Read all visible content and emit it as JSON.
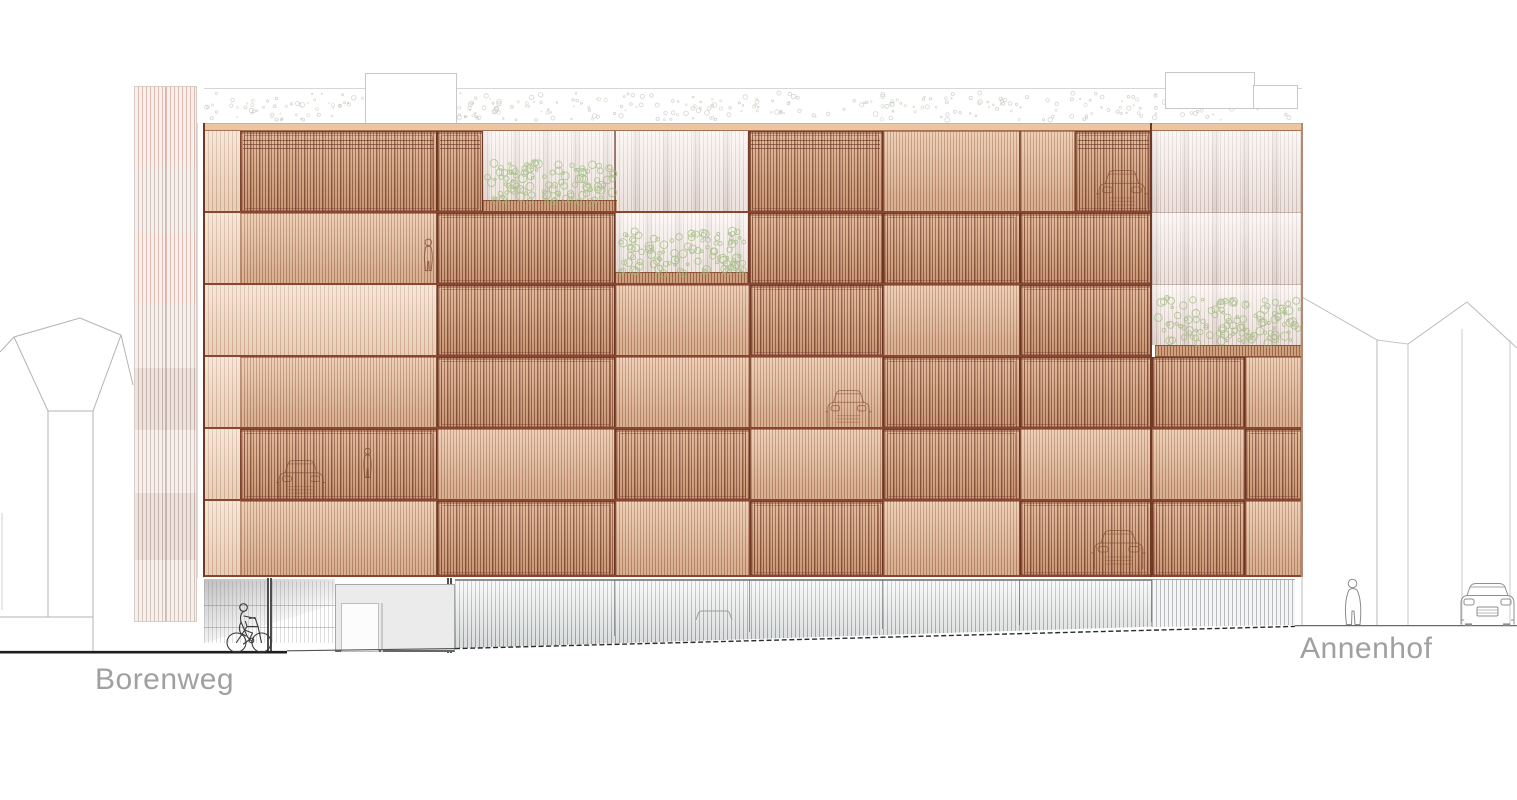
{
  "labels": {
    "street_left": "Borenweg",
    "street_right": "Annenhof"
  },
  "colors": {
    "terracotta_base": "#e8c4a5",
    "terracotta_frame": "#8a4430",
    "terracotta_dark": "#6e3a26",
    "ghost_recess": "#f8f0ec",
    "planter_wood": "#cfa07e",
    "gray_screen": "#8f8f8f",
    "vegetation_green": "#9ab877",
    "roof_planting_gray": "#aeb6a8",
    "outline_gray": "#b3b3b3",
    "figure_dark": "#3a3a3a",
    "label_gray": "#a0a0a0"
  },
  "icons": [
    "cyclist-icon",
    "pedestrian-icon",
    "car-front-icon",
    "car-behind-screen-icon",
    "person-behind-screen-icon",
    "shrub-icon",
    "roof-planting-icon"
  ],
  "rects": [
    {
      "n": "roof-parapet-line",
      "c": "hline",
      "x": 204,
      "y": 88,
      "w": 1098,
      "h": 1
    },
    {
      "n": "rooftop-box",
      "c": "roofbox",
      "x": 365,
      "y": 73,
      "w": 92,
      "h": 51
    },
    {
      "n": "rooftop-box",
      "c": "roofbox",
      "x": 1165,
      "y": 72,
      "w": 90,
      "h": 37
    },
    {
      "n": "rooftop-box",
      "c": "roofbox",
      "x": 1253,
      "y": 85,
      "w": 45,
      "h": 24
    },
    {
      "n": "tower-block",
      "c": "t-r",
      "x": 134,
      "y": 86,
      "w": 63,
      "h": 81
    },
    {
      "n": "tower-block",
      "c": "t-a",
      "x": 134,
      "y": 167,
      "w": 63,
      "h": 66
    },
    {
      "n": "tower-block",
      "c": "t-r",
      "x": 134,
      "y": 233,
      "w": 63,
      "h": 70
    },
    {
      "n": "tower-block",
      "c": "t-a",
      "x": 134,
      "y": 303,
      "w": 63,
      "h": 65
    },
    {
      "n": "tower-block",
      "c": "t-b",
      "x": 134,
      "y": 368,
      "w": 63,
      "h": 62
    },
    {
      "n": "tower-block",
      "c": "t-a",
      "x": 134,
      "y": 430,
      "w": 63,
      "h": 63
    },
    {
      "n": "tower-block",
      "c": "t-b",
      "x": 134,
      "y": 493,
      "w": 63,
      "h": 67
    },
    {
      "n": "tower-block",
      "c": "t-a",
      "x": 134,
      "y": 560,
      "w": 63,
      "h": 62
    },
    {
      "n": "tower-split",
      "c": "tsplit",
      "x": 165,
      "y": 86,
      "w": 1,
      "h": 536
    },
    {
      "n": "tower-outline",
      "c": "outl",
      "x": 134,
      "y": 86,
      "w": 63,
      "h": 536
    },
    {
      "n": "tower-gap",
      "c": "gap",
      "x": 197,
      "y": 123,
      "w": 7,
      "h": 455
    },
    {
      "n": "facade-parapet",
      "c": "parapet",
      "x": 204,
      "y": 123,
      "w": 1098,
      "h": 8
    },
    {
      "n": "facade-panel",
      "c": "light",
      "x": 204,
      "y": 131,
      "w": 36,
      "h": 82
    },
    {
      "n": "facade-panel",
      "c": "dark lines",
      "x": 240,
      "y": 131,
      "w": 197,
      "h": 82
    },
    {
      "n": "facade-panel",
      "c": "dark lines",
      "x": 437,
      "y": 131,
      "w": 46,
      "h": 82
    },
    {
      "n": "terrace-recess",
      "c": "ghost",
      "x": 483,
      "y": 131,
      "w": 265,
      "h": 82
    },
    {
      "n": "facade-panel",
      "c": "dark lines",
      "x": 748,
      "y": 131,
      "w": 135,
      "h": 82
    },
    {
      "n": "facade-panel",
      "c": "mid",
      "x": 883,
      "y": 131,
      "w": 137,
      "h": 82
    },
    {
      "n": "facade-panel",
      "c": "mid",
      "x": 1020,
      "y": 131,
      "w": 55,
      "h": 82
    },
    {
      "n": "facade-panel",
      "c": "dark lines",
      "x": 1075,
      "y": 131,
      "w": 77,
      "h": 82
    },
    {
      "n": "wing-panel",
      "c": "ghost",
      "x": 1152,
      "y": 131,
      "w": 150,
      "h": 82
    },
    {
      "n": "facade-panel",
      "c": "light",
      "x": 204,
      "y": 213,
      "w": 36,
      "h": 72
    },
    {
      "n": "facade-panel",
      "c": "mid",
      "x": 240,
      "y": 213,
      "w": 197,
      "h": 72
    },
    {
      "n": "facade-panel",
      "c": "dark",
      "x": 437,
      "y": 213,
      "w": 178,
      "h": 72
    },
    {
      "n": "terrace-recess",
      "c": "ghost",
      "x": 615,
      "y": 213,
      "w": 133,
      "h": 72
    },
    {
      "n": "facade-panel",
      "c": "dark",
      "x": 748,
      "y": 213,
      "w": 135,
      "h": 72
    },
    {
      "n": "facade-panel",
      "c": "dark",
      "x": 883,
      "y": 213,
      "w": 137,
      "h": 72
    },
    {
      "n": "facade-panel",
      "c": "dark",
      "x": 1020,
      "y": 213,
      "w": 132,
      "h": 72
    },
    {
      "n": "wing-panel",
      "c": "ghost",
      "x": 1152,
      "y": 213,
      "w": 150,
      "h": 72
    },
    {
      "n": "facade-panel",
      "c": "light",
      "x": 204,
      "y": 285,
      "w": 36,
      "h": 72
    },
    {
      "n": "facade-panel",
      "c": "light",
      "x": 240,
      "y": 285,
      "w": 197,
      "h": 72
    },
    {
      "n": "facade-panel",
      "c": "dark",
      "x": 437,
      "y": 285,
      "w": 178,
      "h": 72
    },
    {
      "n": "facade-panel",
      "c": "mid",
      "x": 615,
      "y": 285,
      "w": 135,
      "h": 72
    },
    {
      "n": "facade-panel",
      "c": "dark",
      "x": 750,
      "y": 285,
      "w": 133,
      "h": 72
    },
    {
      "n": "facade-panel",
      "c": "mid",
      "x": 883,
      "y": 285,
      "w": 137,
      "h": 72
    },
    {
      "n": "facade-panel",
      "c": "dark",
      "x": 1020,
      "y": 285,
      "w": 132,
      "h": 72
    },
    {
      "n": "wing-panel",
      "c": "ghost",
      "x": 1152,
      "y": 285,
      "w": 150,
      "h": 60
    },
    {
      "n": "facade-panel",
      "c": "light",
      "x": 204,
      "y": 357,
      "w": 36,
      "h": 72
    },
    {
      "n": "facade-panel",
      "c": "mid",
      "x": 240,
      "y": 357,
      "w": 197,
      "h": 72
    },
    {
      "n": "facade-panel",
      "c": "dark",
      "x": 437,
      "y": 357,
      "w": 178,
      "h": 72
    },
    {
      "n": "facade-panel",
      "c": "mid",
      "x": 615,
      "y": 357,
      "w": 135,
      "h": 72
    },
    {
      "n": "facade-panel",
      "c": "mid",
      "x": 750,
      "y": 357,
      "w": 133,
      "h": 72
    },
    {
      "n": "facade-panel",
      "c": "dark",
      "x": 883,
      "y": 357,
      "w": 137,
      "h": 72
    },
    {
      "n": "facade-panel",
      "c": "dark",
      "x": 1020,
      "y": 357,
      "w": 132,
      "h": 72
    },
    {
      "n": "wing-panel",
      "c": "dark",
      "x": 1152,
      "y": 357,
      "w": 93,
      "h": 72
    },
    {
      "n": "wing-panel",
      "c": "mid",
      "x": 1245,
      "y": 357,
      "w": 57,
      "h": 72
    },
    {
      "n": "facade-panel",
      "c": "light",
      "x": 204,
      "y": 429,
      "w": 36,
      "h": 72
    },
    {
      "n": "facade-panel",
      "c": "dark",
      "x": 240,
      "y": 429,
      "w": 197,
      "h": 72
    },
    {
      "n": "facade-panel",
      "c": "mid",
      "x": 437,
      "y": 429,
      "w": 178,
      "h": 72
    },
    {
      "n": "facade-panel",
      "c": "dark",
      "x": 615,
      "y": 429,
      "w": 135,
      "h": 72
    },
    {
      "n": "facade-panel",
      "c": "mid",
      "x": 750,
      "y": 429,
      "w": 133,
      "h": 72
    },
    {
      "n": "facade-panel",
      "c": "dark",
      "x": 883,
      "y": 429,
      "w": 137,
      "h": 72
    },
    {
      "n": "facade-panel",
      "c": "mid",
      "x": 1020,
      "y": 429,
      "w": 132,
      "h": 72
    },
    {
      "n": "wing-panel",
      "c": "mid",
      "x": 1152,
      "y": 429,
      "w": 93,
      "h": 72
    },
    {
      "n": "wing-panel",
      "c": "dark",
      "x": 1245,
      "y": 429,
      "w": 57,
      "h": 72
    },
    {
      "n": "facade-panel",
      "c": "light",
      "x": 204,
      "y": 501,
      "w": 36,
      "h": 76
    },
    {
      "n": "facade-panel",
      "c": "mid",
      "x": 240,
      "y": 501,
      "w": 197,
      "h": 76
    },
    {
      "n": "facade-panel",
      "c": "dark",
      "x": 437,
      "y": 501,
      "w": 178,
      "h": 76
    },
    {
      "n": "facade-panel",
      "c": "mid",
      "x": 615,
      "y": 501,
      "w": 135,
      "h": 76
    },
    {
      "n": "facade-panel",
      "c": "dark",
      "x": 750,
      "y": 501,
      "w": 133,
      "h": 76
    },
    {
      "n": "facade-panel",
      "c": "mid",
      "x": 883,
      "y": 501,
      "w": 137,
      "h": 76
    },
    {
      "n": "facade-panel",
      "c": "dark",
      "x": 1020,
      "y": 501,
      "w": 132,
      "h": 76
    },
    {
      "n": "wing-panel",
      "c": "dark",
      "x": 1152,
      "y": 501,
      "w": 93,
      "h": 76
    },
    {
      "n": "wing-panel",
      "c": "mid",
      "x": 1245,
      "y": 501,
      "w": 57,
      "h": 76
    },
    {
      "n": "terrace-planter",
      "c": "planter",
      "x": 483,
      "y": 200,
      "w": 134,
      "h": 13
    },
    {
      "n": "terrace-planter",
      "c": "planter",
      "x": 615,
      "y": 272,
      "w": 133,
      "h": 13
    },
    {
      "n": "wing-planter",
      "c": "planter",
      "x": 1155,
      "y": 345,
      "w": 147,
      "h": 12
    },
    {
      "n": "bay-divider",
      "c": "vdiv",
      "x": 436,
      "y": 131,
      "w": 2,
      "h": 446
    },
    {
      "n": "bay-divider",
      "c": "vdiv",
      "x": 614,
      "y": 131,
      "w": 2,
      "h": 446
    },
    {
      "n": "bay-divider",
      "c": "vdiv",
      "x": 749,
      "y": 131,
      "w": 2,
      "h": 446
    },
    {
      "n": "bay-divider",
      "c": "vdiv",
      "x": 882,
      "y": 131,
      "w": 2,
      "h": 446
    },
    {
      "n": "bay-divider",
      "c": "vdiv",
      "x": 1019,
      "y": 131,
      "w": 2,
      "h": 446
    },
    {
      "n": "bay-divider",
      "c": "vdiv",
      "x": 1244,
      "y": 357,
      "w": 2,
      "h": 220
    },
    {
      "n": "floor-line",
      "c": "rowline",
      "x": 204,
      "y": 211,
      "w": 948,
      "h": 2
    },
    {
      "n": "floor-line",
      "c": "rowline",
      "x": 204,
      "y": 283,
      "w": 948,
      "h": 2
    },
    {
      "n": "floor-line",
      "c": "rowline",
      "x": 204,
      "y": 355,
      "w": 948,
      "h": 2
    },
    {
      "n": "floor-line",
      "c": "rowline",
      "x": 204,
      "y": 427,
      "w": 948,
      "h": 2
    },
    {
      "n": "floor-line",
      "c": "rowline",
      "x": 204,
      "y": 499,
      "w": 948,
      "h": 2
    },
    {
      "n": "floor-line-wing",
      "c": "wline",
      "x": 1152,
      "y": 212,
      "w": 150,
      "h": 1
    },
    {
      "n": "floor-line-wing",
      "c": "wline",
      "x": 1152,
      "y": 284,
      "w": 150,
      "h": 1
    },
    {
      "n": "floor-line-wing",
      "c": "rowline",
      "x": 1152,
      "y": 427,
      "w": 150,
      "h": 2
    },
    {
      "n": "floor-line-wing",
      "c": "rowline",
      "x": 1152,
      "y": 499,
      "w": 150,
      "h": 2
    },
    {
      "n": "facade-bottom-line",
      "c": "rowline",
      "x": 204,
      "y": 575,
      "w": 1098,
      "h": 2
    },
    {
      "n": "facade-edge",
      "c": "edge",
      "x": 203,
      "y": 123,
      "w": 2,
      "h": 454
    },
    {
      "n": "facade-edge",
      "c": "edge",
      "x": 1150,
      "y": 123,
      "w": 2,
      "h": 454
    },
    {
      "n": "wing-edge",
      "c": "edgel",
      "x": 1301,
      "y": 123,
      "w": 2,
      "h": 454
    },
    {
      "n": "groundfloor-interior",
      "c": "intg",
      "x": 204,
      "y": 581,
      "w": 131,
      "h": 62
    },
    {
      "n": "groundfloor-shadow",
      "c": "wedge",
      "x": 204,
      "y": 579,
      "w": 131,
      "h": 64
    },
    {
      "n": "column",
      "c": "col",
      "x": 267,
      "y": 578,
      "w": 5,
      "h": 74
    },
    {
      "n": "column",
      "c": "col",
      "x": 447,
      "y": 578,
      "w": 5,
      "h": 75
    },
    {
      "n": "entrance-lobby",
      "c": "lobby",
      "x": 335,
      "y": 584,
      "w": 120,
      "h": 68
    },
    {
      "n": "entrance-door",
      "c": "door",
      "x": 341,
      "y": 603,
      "w": 38,
      "h": 49
    },
    {
      "n": "entrance-door-divider",
      "c": "ddiv",
      "x": 381,
      "y": 603,
      "w": 2,
      "h": 49
    },
    {
      "n": "groundfloor-screen",
      "c": "graybase",
      "x": 455,
      "y": 579,
      "w": 697,
      "h": 70
    },
    {
      "n": "groundfloor-screen-wing",
      "c": "graybase2",
      "x": 1152,
      "y": 579,
      "w": 143,
      "h": 48
    },
    {
      "n": "base-divider",
      "c": "bdiv",
      "x": 614,
      "y": 580,
      "w": 1,
      "h": 56
    },
    {
      "n": "base-divider",
      "c": "bdiv",
      "x": 749,
      "y": 580,
      "w": 1,
      "h": 52
    },
    {
      "n": "base-divider",
      "c": "bdiv",
      "x": 882,
      "y": 580,
      "w": 1,
      "h": 49
    },
    {
      "n": "base-divider",
      "c": "bdiv",
      "x": 1019,
      "y": 580,
      "w": 1,
      "h": 45
    },
    {
      "n": "base-divider",
      "c": "bdiv",
      "x": 1151,
      "y": 580,
      "w": 1,
      "h": 42
    }
  ],
  "vegetation": [
    {
      "name": "roof-planting",
      "layer": "bg",
      "x": 206,
      "y": 93,
      "w": 1090,
      "h": 27,
      "color": "#aeb6a8",
      "count": 240,
      "rmin": 0.6,
      "rmax": 2.4,
      "opacity": 0.55
    },
    {
      "name": "roof-planting-green",
      "layer": "bg",
      "x": 206,
      "y": 98,
      "w": 1090,
      "h": 22,
      "color": "#a8bc90",
      "count": 120,
      "rmin": 0.5,
      "rmax": 1.8,
      "opacity": 0.4
    },
    {
      "name": "terrace-shrubs-upper",
      "layer": "fg",
      "x": 486,
      "y": 162,
      "w": 128,
      "h": 41,
      "color": "#9ab877",
      "count": 115,
      "rmin": 1.2,
      "rmax": 4.2,
      "opacity": 0.7
    },
    {
      "name": "terrace-shrubs-lower",
      "layer": "fg",
      "x": 621,
      "y": 231,
      "w": 125,
      "h": 43,
      "color": "#9ab877",
      "count": 110,
      "rmin": 1.2,
      "rmax": 4.2,
      "opacity": 0.7
    },
    {
      "name": "wing-shrubs",
      "layer": "fg",
      "x": 1158,
      "y": 298,
      "w": 142,
      "h": 46,
      "color": "#9ab877",
      "count": 125,
      "rmin": 1.2,
      "rmax": 4.2,
      "opacity": 0.7
    }
  ]
}
